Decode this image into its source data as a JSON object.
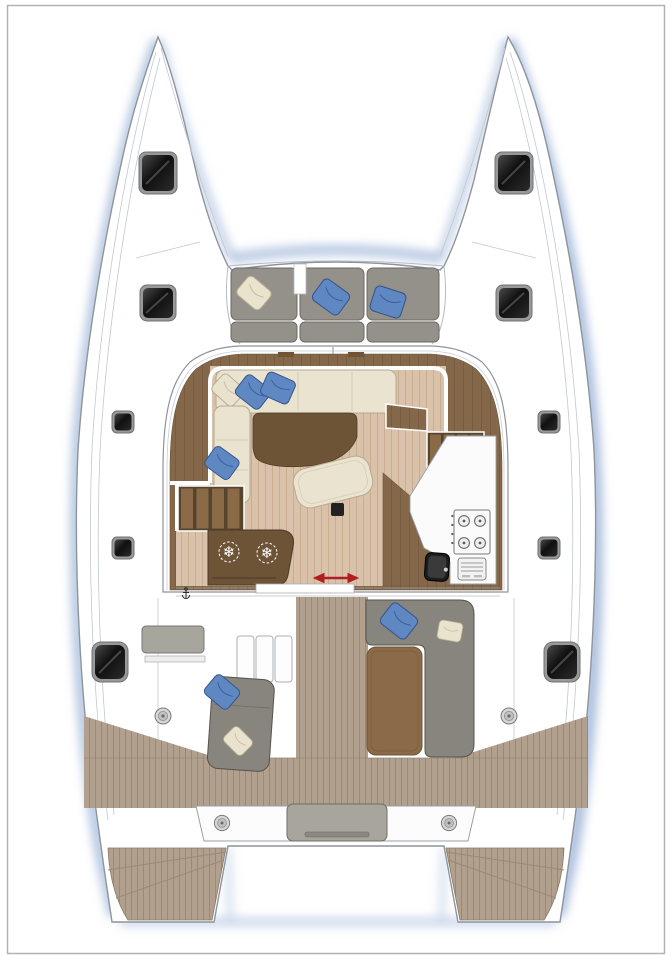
{
  "diagram": {
    "type": "boat-floor-plan",
    "subject": "sailing catamaran deck and saloon layout, bow up, top view"
  },
  "palette": {
    "hull-line": "#8d949c",
    "hull-line-light": "#c2c8cf",
    "shadow-blue": "#9fb6d8",
    "wood-dark": "#85684a",
    "wood-dark-line": "#6d5339",
    "wood-table": "#6e5436",
    "floor-wood": "#d9c2a9",
    "floor-line": "#c8ad90",
    "teak": "#b1a08d",
    "teak-line": "#9a8975",
    "sofa-cream": "#eae3cf",
    "sofa-cream-line": "#b5ab90",
    "cushion-gray": "#94908a",
    "cushion-gray-line": "#6e6a63",
    "aft-gray": "#87857d",
    "aft-gray-line": "#55534d",
    "bench-gray": "#a7a59c",
    "pillow-blue": "#5f87c2",
    "pillow-blue-line": "#33538c",
    "stair-slat": "#8a6a47",
    "stair-bg": "#57442c",
    "window-dark": "#1c1c1c",
    "window-frame": "#97999b",
    "arrow-red": "#b01f1f",
    "winch-gray": "#d6d6d6",
    "counter-white": "#fbfbfb"
  },
  "icons": {
    "snowflake_glyph": "❄",
    "names": [
      "snowflake-icon",
      "anchor-icon",
      "winch-icon",
      "stove-burner-icon",
      "slide-direction-arrow-icon",
      "deck-hatch-icon",
      "hull-window-icon"
    ]
  },
  "inventory": {
    "bow_hatches": 4,
    "side_deck_hatches": 4,
    "cockpit_windows": 2,
    "forward_cockpit": {
      "seat_sections": 3,
      "pillows": [
        "cream",
        "blue",
        "blue"
      ]
    },
    "saloon": {
      "settee": "L-shaped sofa",
      "pillows": [
        "cream",
        "blue",
        "blue",
        "blue"
      ],
      "table": "curved cocktail table",
      "ottoman": "curved bench",
      "fridge_snowflakes": 2,
      "stove_burners": 4,
      "oven": 1,
      "sink": 1,
      "companionway_stairs": 2,
      "sliding_door_arrow": 1
    },
    "aft_cockpit": {
      "port_bench": 1,
      "port_chaise": 1,
      "starboard_sofa": "L-shaped",
      "table": 1,
      "steps": 3,
      "winches": 4,
      "pillows": [
        "blue",
        "cream",
        "blue",
        "cream"
      ]
    },
    "stern": {
      "transom_platforms": 2,
      "engine_hatch_cushion": 1
    }
  }
}
